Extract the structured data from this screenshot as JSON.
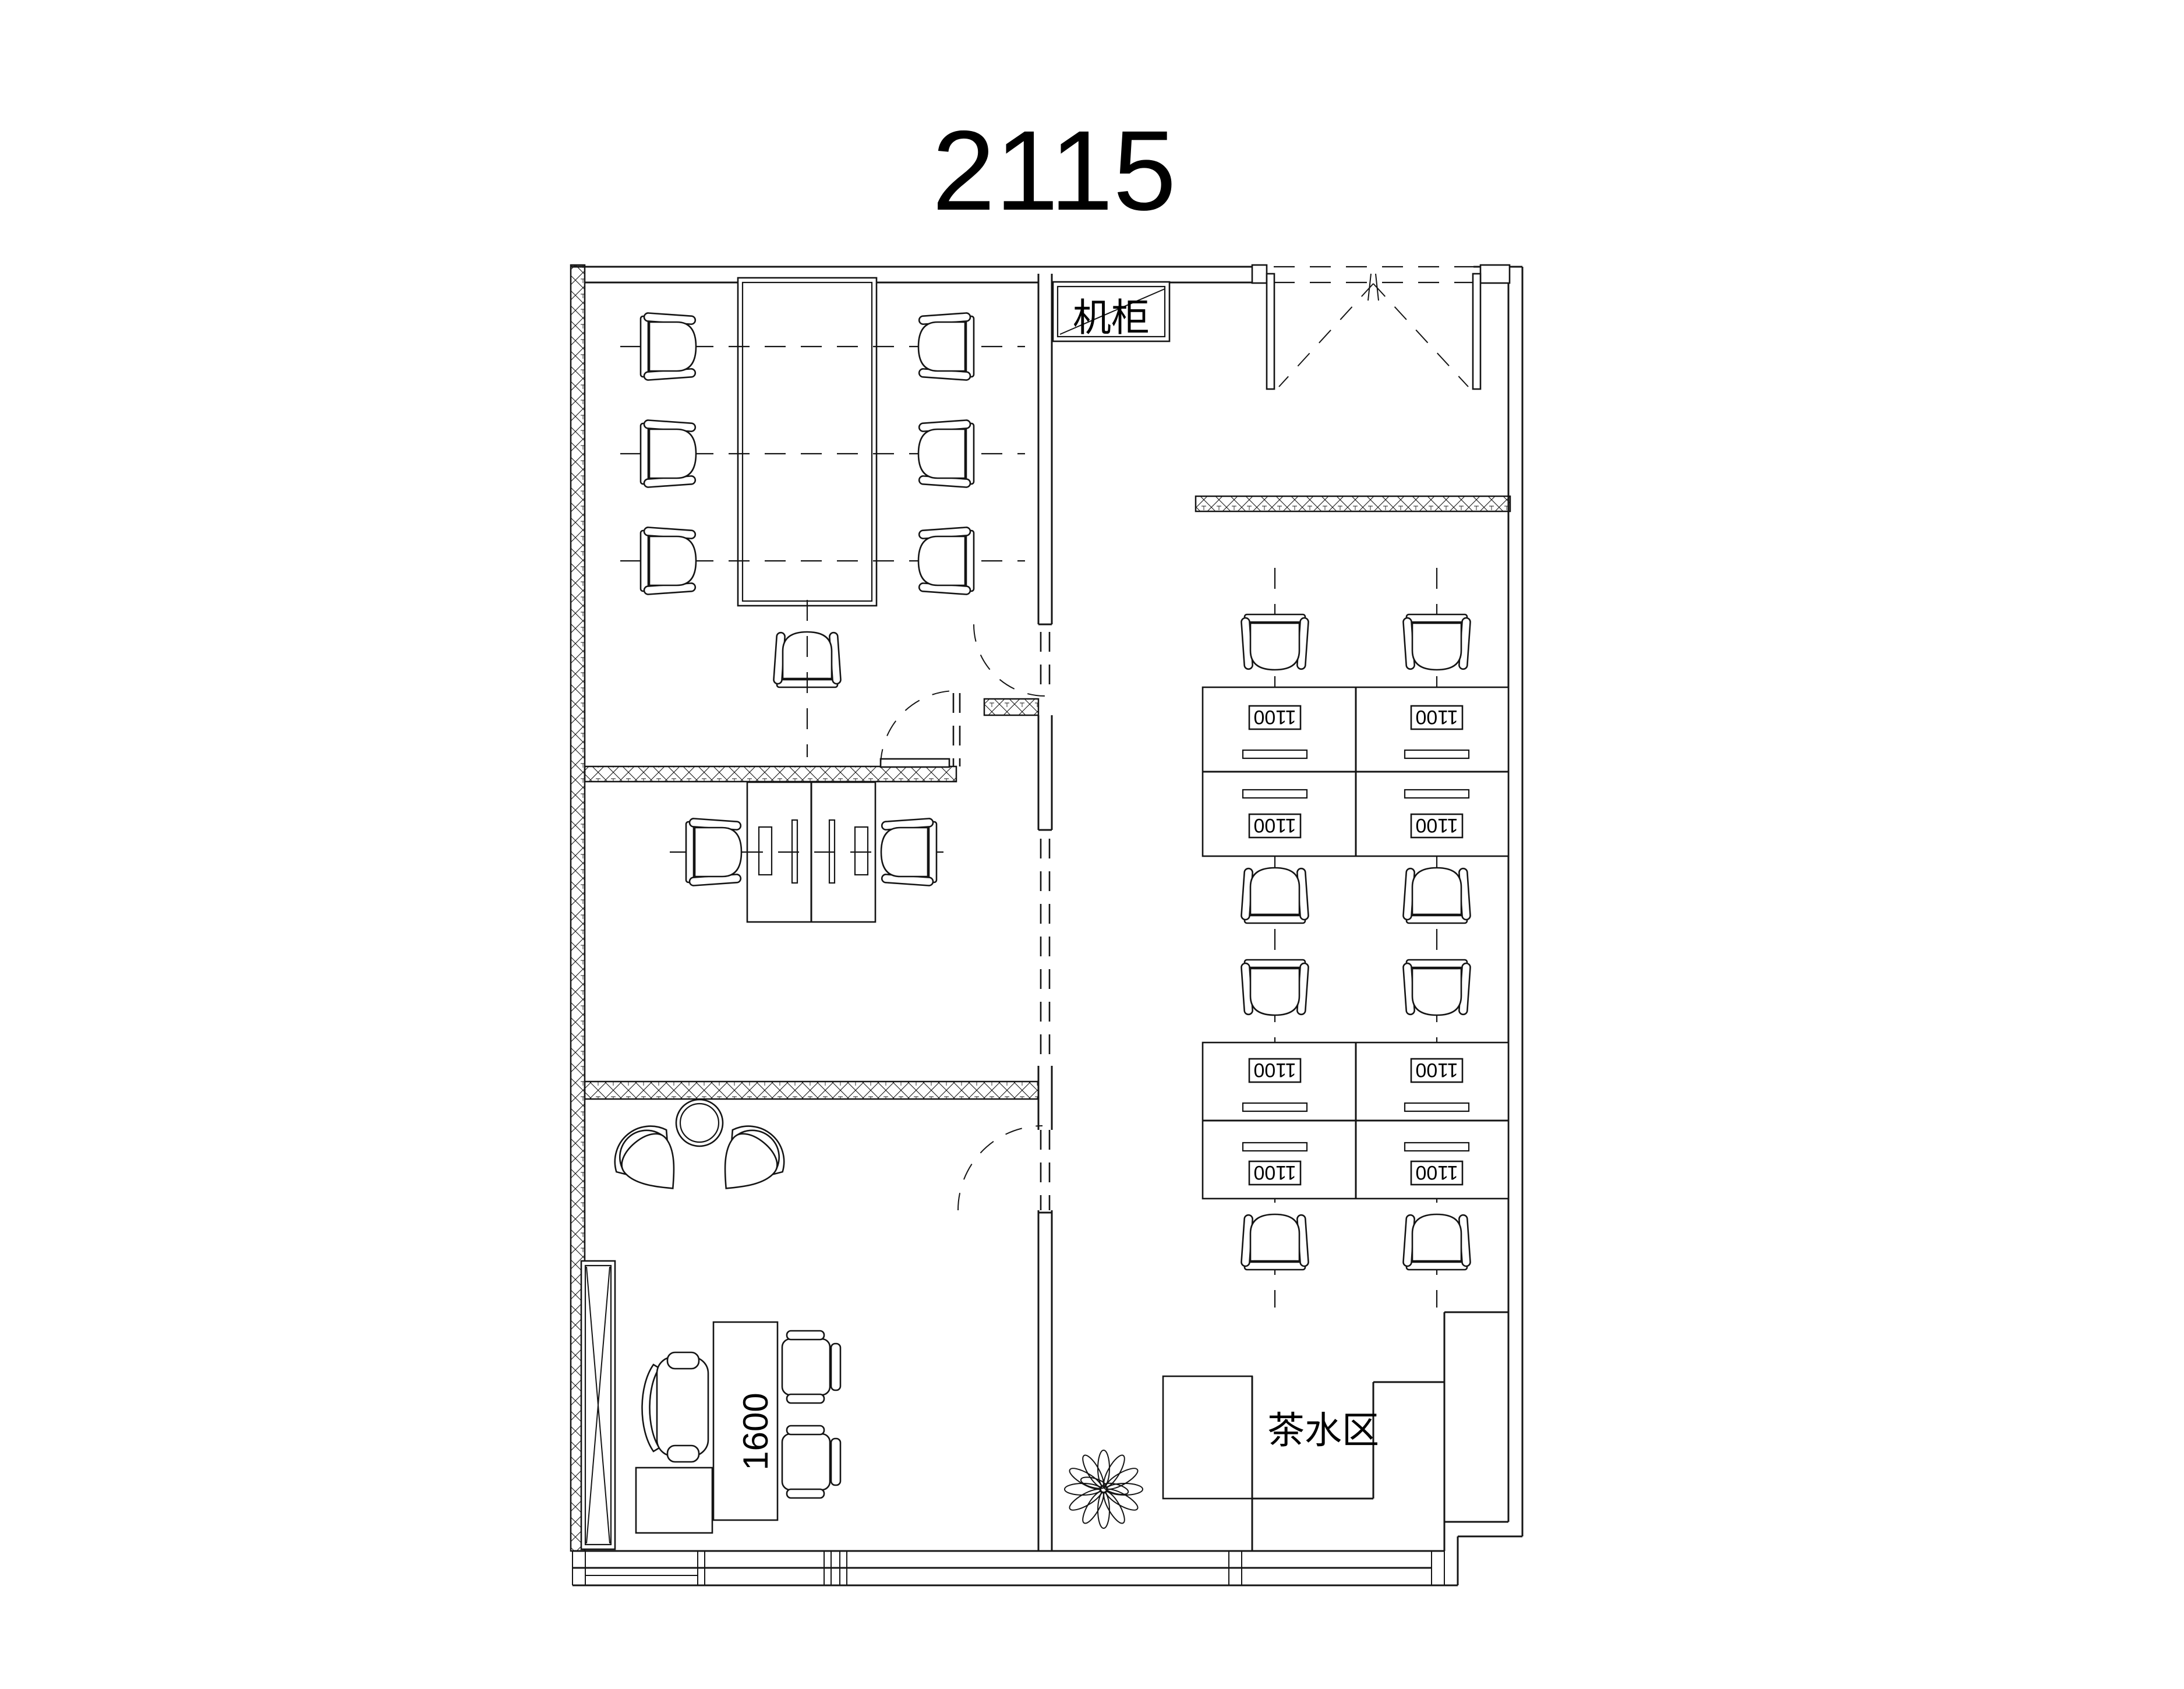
{
  "title": "2115",
  "labels": {
    "server_cabinet": "机柜",
    "tea_area": "茶水区",
    "desk_dimension": "1600"
  },
  "open_office": {
    "desks": [
      {
        "label": "1100"
      },
      {
        "label": "1100"
      },
      {
        "label": "1100"
      },
      {
        "label": "1100"
      },
      {
        "label": "1100"
      },
      {
        "label": "1100"
      },
      {
        "label": "1100"
      },
      {
        "label": "1100"
      }
    ]
  }
}
